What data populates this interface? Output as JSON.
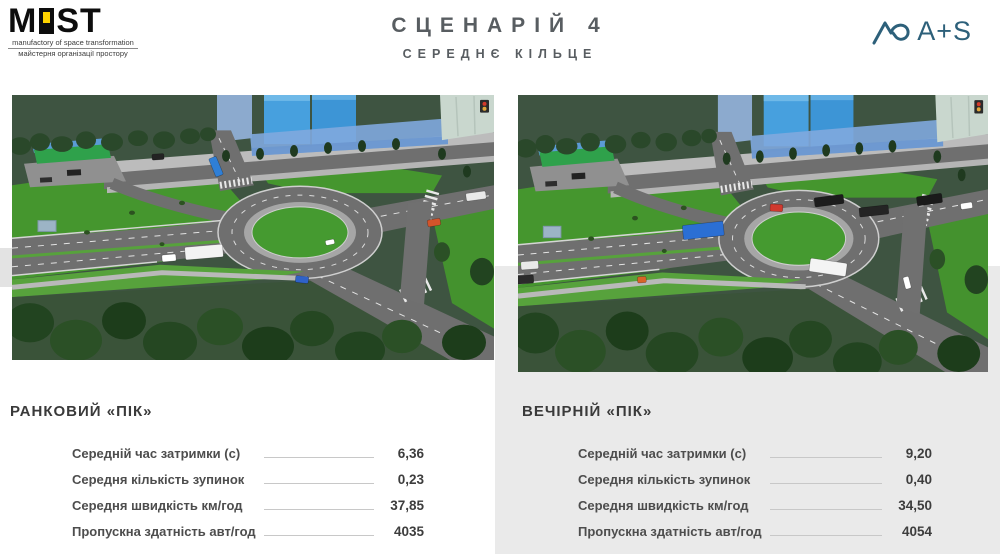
{
  "header": {
    "logo": {
      "word_m": "M",
      "word_st": "ST",
      "tagline_en": "manufactory of space transformation",
      "tagline_ua": "майстерня організації простору"
    },
    "title": "СЦЕНАРІЙ 4",
    "subtitle": "СЕРЕДНЄ КІЛЬЦЕ",
    "partner_text": "A+S"
  },
  "panels": [
    {
      "heading": "РАНКОВИЙ «ПІК»",
      "rows": [
        {
          "label": "Середній час затримки (с)",
          "value": "6,36"
        },
        {
          "label": "Середня кількість зупинок",
          "value": "0,23"
        },
        {
          "label": "Середня швидкість км/год",
          "value": "37,85"
        },
        {
          "label": "Пропускна здатність авт/год",
          "value": "4035"
        }
      ]
    },
    {
      "heading": "ВЕЧІРНІЙ «ПІК»",
      "rows": [
        {
          "label": "Середній час затримки (с)",
          "value": "9,20"
        },
        {
          "label": "Середня кількість зупинок",
          "value": "0,40"
        },
        {
          "label": "Середня швидкість км/год",
          "value": "34,50"
        },
        {
          "label": "Пропускна здатність авт/год",
          "value": "4054"
        }
      ]
    }
  ],
  "colors": {
    "accent_blue": "#2d607a",
    "logo_yellow": "#ffd400",
    "panel_gray": "#eaeaea",
    "title_gray": "#585d61",
    "grass_green": "#45962e",
    "road_gray": "#6f6f6f"
  },
  "scenes": {
    "left": {
      "vehicles": [
        {
          "x": 192,
          "y": 160,
          "w": 38,
          "h": 13,
          "color": "#f3f3f3",
          "rot": -5
        },
        {
          "x": 157,
          "y": 166,
          "w": 14,
          "h": 7,
          "color": "#ffffff",
          "rot": -5
        },
        {
          "x": 204,
          "y": 73,
          "w": 20,
          "h": 8,
          "color": "#2f7fd6",
          "rot": 68
        },
        {
          "x": 290,
          "y": 188,
          "w": 13,
          "h": 7,
          "color": "#2f62c8",
          "rot": 6
        },
        {
          "x": 422,
          "y": 130,
          "w": 13,
          "h": 7,
          "color": "#d4542a",
          "rot": -10
        },
        {
          "x": 146,
          "y": 63,
          "w": 12,
          "h": 6,
          "color": "#232323",
          "rot": -4
        },
        {
          "x": 464,
          "y": 103,
          "w": 20,
          "h": 8,
          "color": "#e9e9e9",
          "rot": -8
        },
        {
          "x": 318,
          "y": 150,
          "w": 9,
          "h": 5,
          "color": "#ffffff",
          "rot": -12
        }
      ]
    },
    "right": {
      "vehicles": [
        {
          "x": 190,
          "y": 132,
          "w": 42,
          "h": 14,
          "color": "#2b6fd4",
          "rot": -6
        },
        {
          "x": 318,
          "y": 168,
          "w": 38,
          "h": 13,
          "color": "#f4f4f4",
          "rot": 8
        },
        {
          "x": 265,
          "y": 110,
          "w": 13,
          "h": 7,
          "color": "#d0392e",
          "rot": 3
        },
        {
          "x": 319,
          "y": 103,
          "w": 30,
          "h": 9,
          "color": "#1c1c1c",
          "rot": -7
        },
        {
          "x": 365,
          "y": 113,
          "w": 30,
          "h": 9,
          "color": "#242424",
          "rot": -6
        },
        {
          "x": 422,
          "y": 102,
          "w": 26,
          "h": 9,
          "color": "#1a1a1a",
          "rot": -8
        },
        {
          "x": 460,
          "y": 108,
          "w": 12,
          "h": 6,
          "color": "#ffffff",
          "rot": -8
        },
        {
          "x": 399,
          "y": 183,
          "w": 12,
          "h": 6,
          "color": "#ffffff",
          "rot": 75
        },
        {
          "x": 12,
          "y": 166,
          "w": 18,
          "h": 8,
          "color": "#e9e9e9",
          "rot": -4
        },
        {
          "x": 5,
          "y": 180,
          "w": 22,
          "h": 8,
          "color": "#2b2b2b",
          "rot": -4
        },
        {
          "x": 127,
          "y": 180,
          "w": 9,
          "h": 6,
          "color": "#d86428",
          "rot": -4
        }
      ]
    }
  }
}
